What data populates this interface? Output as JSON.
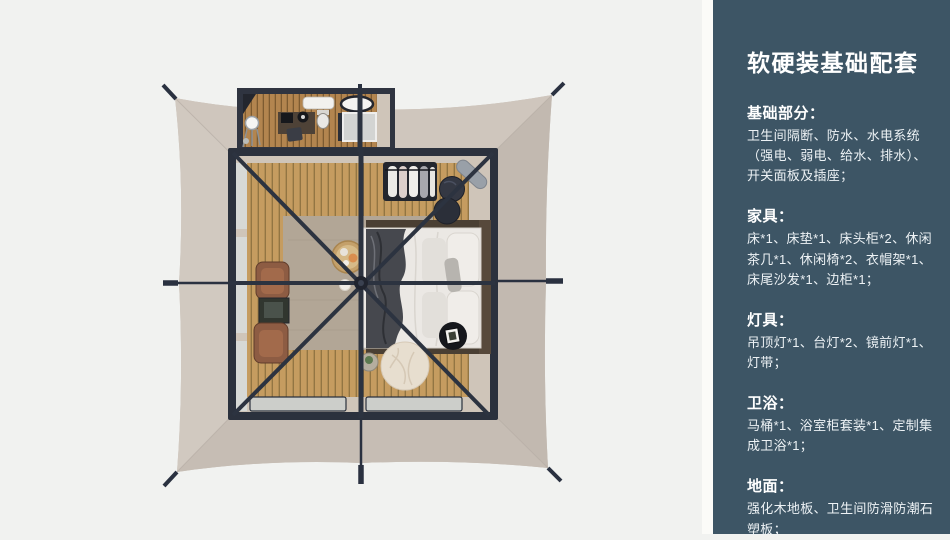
{
  "sidebar": {
    "bg_color": "#3d5565",
    "text_color": "#ffffff",
    "title": "软硬装基础配套",
    "sections": [
      {
        "heading": "基础部分：",
        "body": "卫生间隔断、防水、水电系统（强电、弱电、给水、排水）、开关面板及插座；"
      },
      {
        "heading": "家具：",
        "body": "床*1、床垫*1、床头柜*2、休闲茶几*1、休闲椅*2、衣帽架*1、床尾沙发*1、边柜*1；"
      },
      {
        "heading": "灯具：",
        "body": "吊顶灯*1、台灯*2、镜前灯*1、灯带；"
      },
      {
        "heading": "卫浴：",
        "body": "马桶*1、浴室柜套装*1、定制集成卫浴*1；"
      },
      {
        "heading": "地面：",
        "body": "强化木地板、卫生间防滑防潮石塑板；"
      }
    ]
  },
  "floorplan": {
    "view": "top-down tent suite render",
    "colors": {
      "page_bg": "#f1f2f0",
      "tent_canvas": "#c9c0b7",
      "canvas_light": "#d1c9c0",
      "canvas_dark": "#c2b9b0",
      "frame_steel": "#2b313d",
      "wood_floor": "#c59c60",
      "bathroom_wood": "#b3854f",
      "rug": "#b2a696",
      "bedding_white": "#ebe8e4",
      "throw_blanket": "#46484e",
      "leather_chair": "#8d5c43",
      "window_glass": "#d7d9d6"
    },
    "items": [
      "tent-canvas",
      "guy-lines-and-stakes",
      "bathroom-unit",
      "shower-tray",
      "washbasin",
      "bathtub-counter",
      "vanity-mirror",
      "coffee-station",
      "toilet",
      "steel-frame",
      "roof-braces",
      "center-pole",
      "wood-slat-floor",
      "mesh-windows",
      "entrance-deck",
      "area-rug",
      "double-bed",
      "headboard",
      "pillows",
      "throw-blanket",
      "clothes-rack",
      "leaning-mirror",
      "floor-poufs",
      "lounge-chairs",
      "side-shelf",
      "breakfast-tray",
      "bean-bag",
      "side-table",
      "decor-tray"
    ]
  }
}
